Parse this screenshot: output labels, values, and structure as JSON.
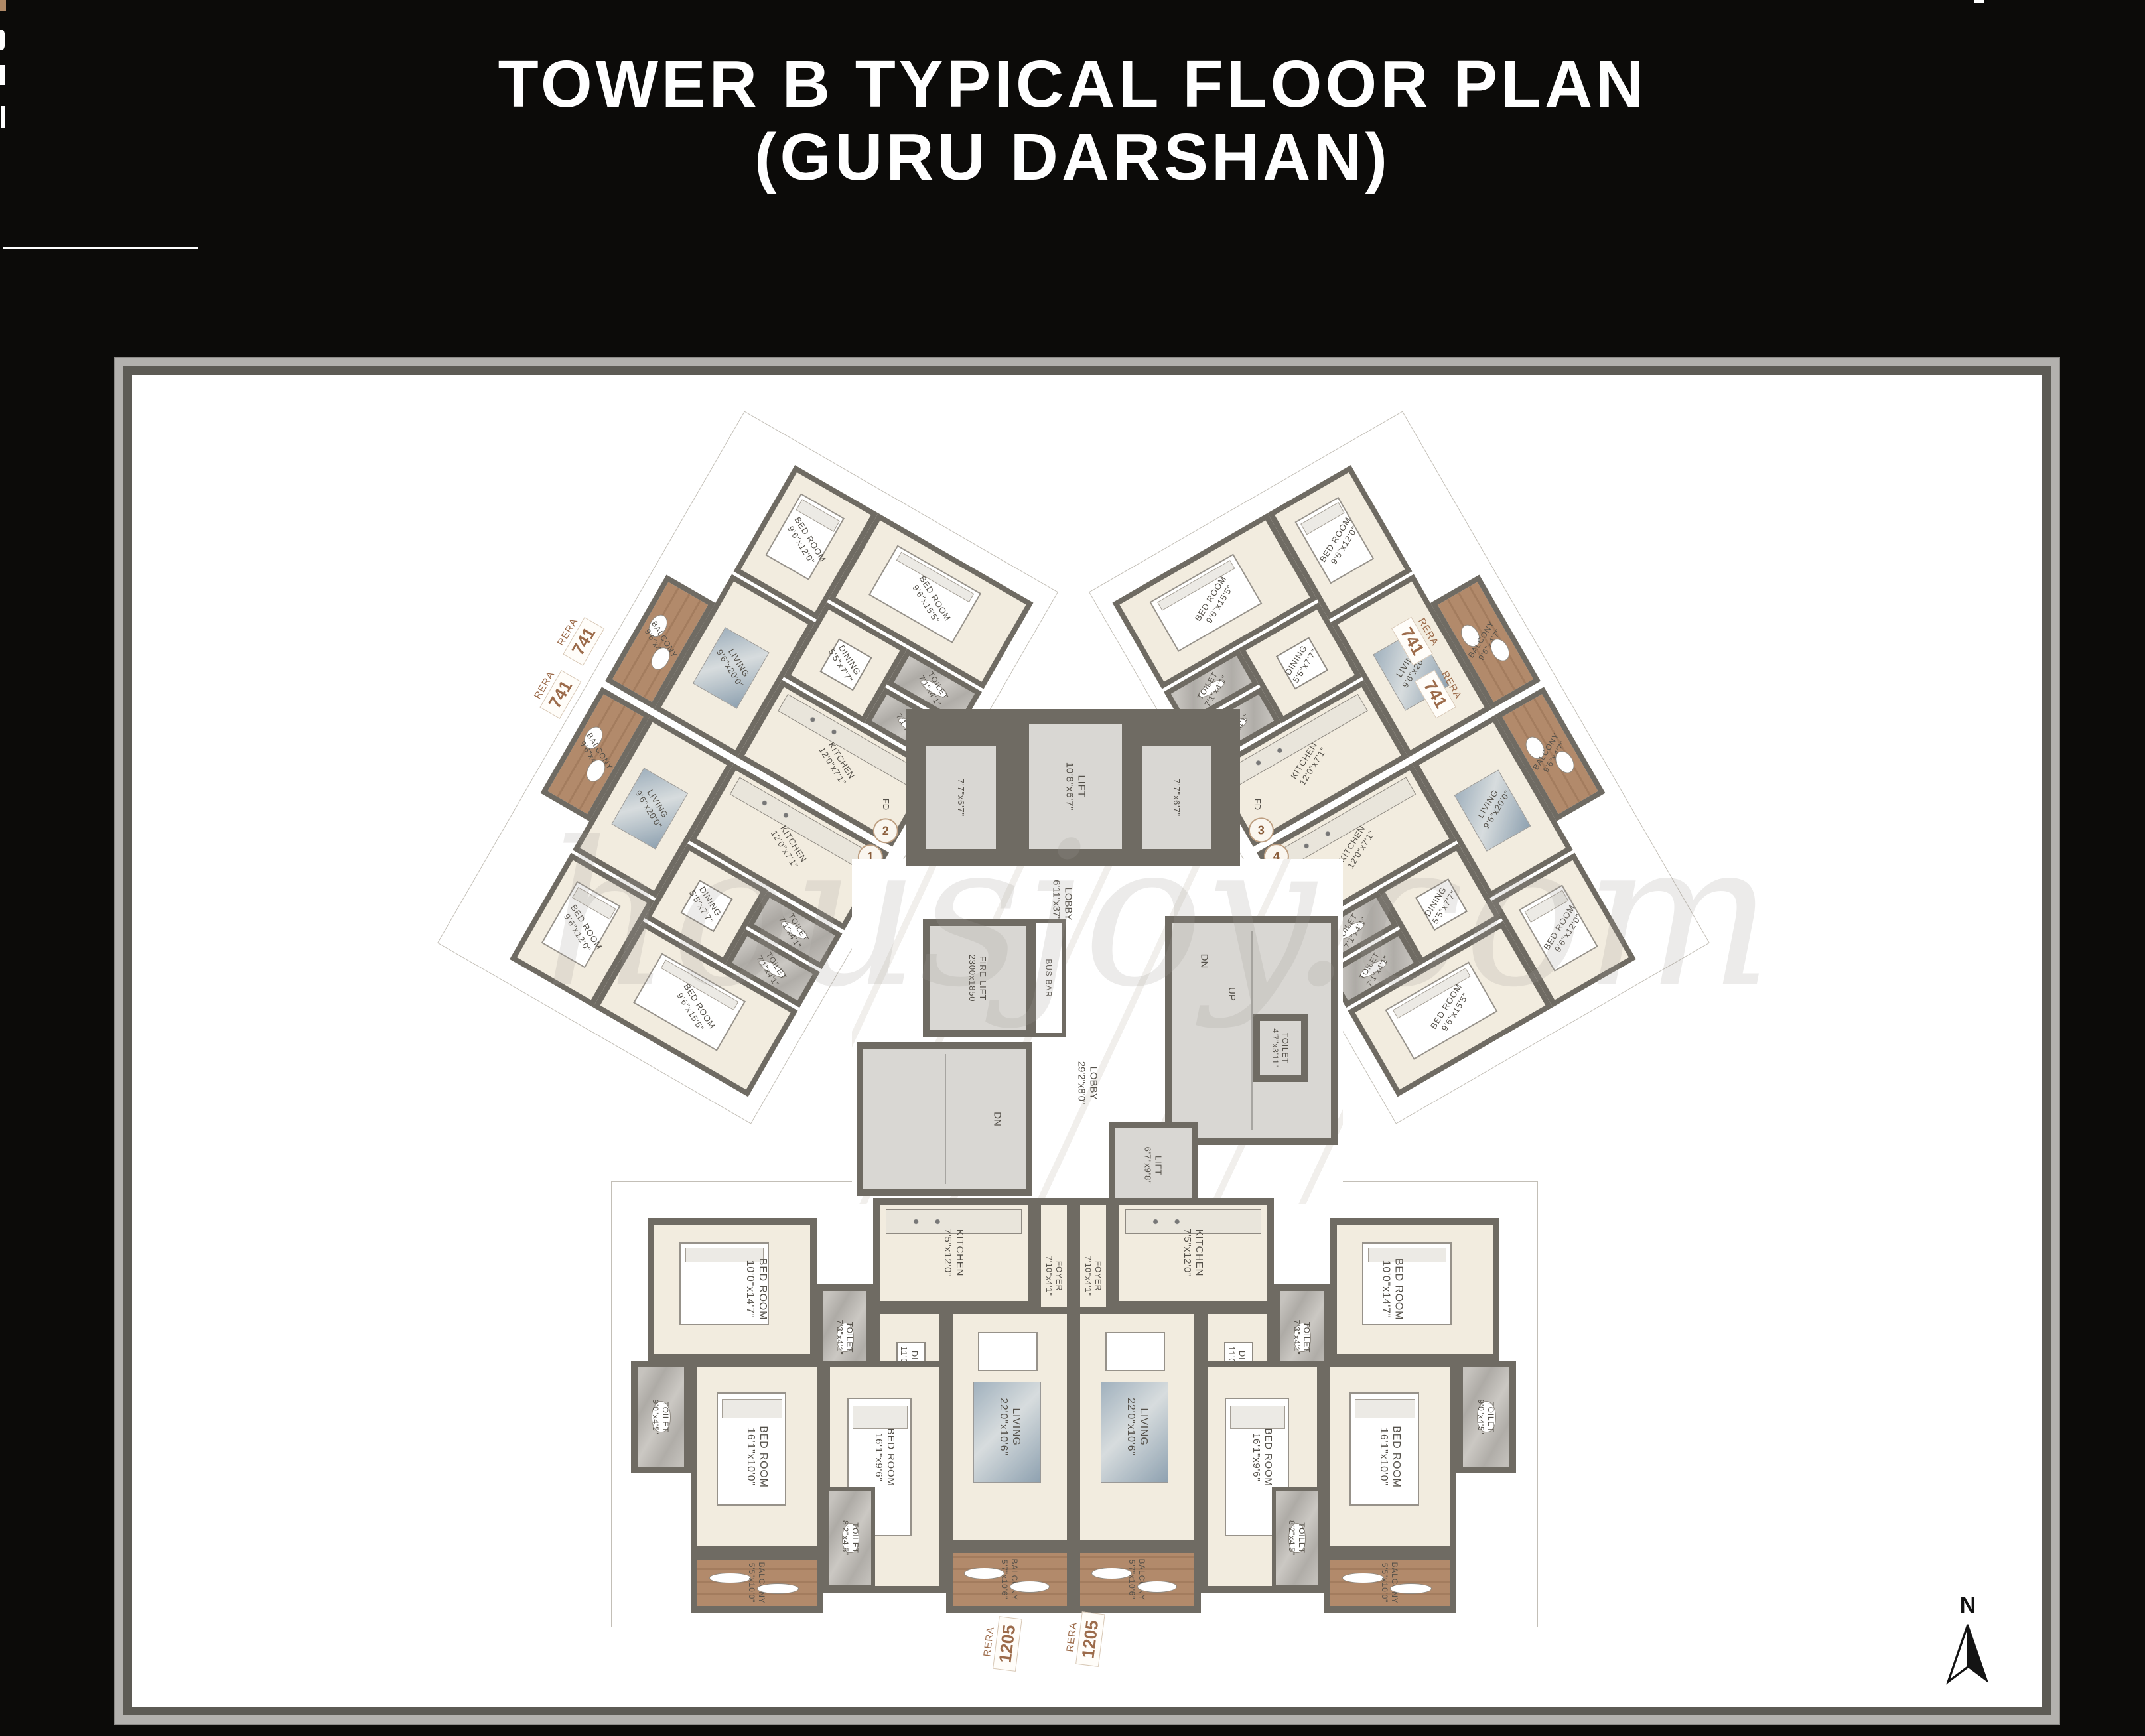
{
  "header": {
    "title_line1": "TOWER B TYPICAL FLOOR PLAN",
    "title_line2": "(GURU DARSHAN)"
  },
  "watermark": "housjoy.com",
  "compass": {
    "label": "N"
  },
  "units": {
    "u1": "1",
    "u2": "2",
    "u3": "3",
    "u4": "4"
  },
  "rera": {
    "wing": {
      "label": "RERA",
      "value": "741"
    },
    "bottom": {
      "label": "RERA",
      "value": "1205"
    }
  },
  "wing_rooms": {
    "living": {
      "name": "LIVING",
      "dims": "9'6\"x20'0\""
    },
    "dining": {
      "name": "DINING",
      "dims": "5'5\"x7'7\""
    },
    "kitchen": {
      "name": "KITCHEN",
      "dims": "12'0\"x7'1\""
    },
    "bed_large": {
      "name": "BED ROOM",
      "dims": "9'6\"x15'5\""
    },
    "bed_small": {
      "name": "BED ROOM",
      "dims": "9'6\"x12'0\""
    },
    "toilet": {
      "name": "TOILET",
      "dims": "7'1\"x4'1\""
    },
    "balcony": {
      "name": "BALCONY",
      "dims": "9'6\"x4'7\""
    }
  },
  "bottom_rooms": {
    "foyer": {
      "name": "FOYER",
      "dims": "7'10\"x4'1\""
    },
    "kitchen": {
      "name": "KITCHEN",
      "dims": "7'5\"x12'0\""
    },
    "dining": {
      "name": "DINING",
      "dims": "11'0\"x5'5\""
    },
    "living": {
      "name": "LIVING",
      "dims": "22'0\"x10'6\""
    },
    "toilet_foyer": {
      "name": "TOILET",
      "dims": "7'3\"x4'1\""
    },
    "bed_master": {
      "name": "BED ROOM",
      "dims": "10'0\"x14'7\""
    },
    "bed_b": {
      "name": "BED ROOM",
      "dims": "16'1\"x10'0\""
    },
    "toilet_b": {
      "name": "TOILET",
      "dims": "9'0\"x4'5\""
    },
    "bed_c": {
      "name": "BED ROOM",
      "dims": "16'1\"x9'6\""
    },
    "toilet_c": {
      "name": "TOILET",
      "dims": "8'2\"x4'5\""
    },
    "balcony_center": {
      "name": "BALCONY",
      "dims": "5'7\"x10'6\""
    },
    "balcony_side": {
      "name": "BALCONY",
      "dims": "5'5\"x10'0\""
    }
  },
  "core": {
    "lift_main": {
      "name": "LIFT",
      "dims": "10'8\"x6'7\""
    },
    "lift_left": {
      "dims": "7'7\"x6'7\""
    },
    "lift_right": {
      "dims": "7'7\"x6'7\""
    },
    "fd": "FD",
    "lobby_upper": {
      "name": "LOBBY",
      "dims": "6'11\"x37'4\""
    },
    "fire_lift": {
      "name": "FIRE LIFT",
      "dims": "2300x1850"
    },
    "bus_bar": "BUS BAR",
    "stair_down": "DN",
    "stair_up": "UP",
    "toilet": {
      "name": "TOILET",
      "dims": "4'7\"x3'11\""
    },
    "lobby_lower": {
      "name": "LOBBY",
      "dims": "29'2\"x8'0\""
    },
    "lift_lower": {
      "name": "LIFT",
      "dims": "6'7\"x9'8\""
    }
  },
  "colors": {
    "wall": "#6f6b63",
    "cream": "#f2ecdf",
    "wood": "#b28a6b",
    "brown_text": "#9c6b4a"
  }
}
